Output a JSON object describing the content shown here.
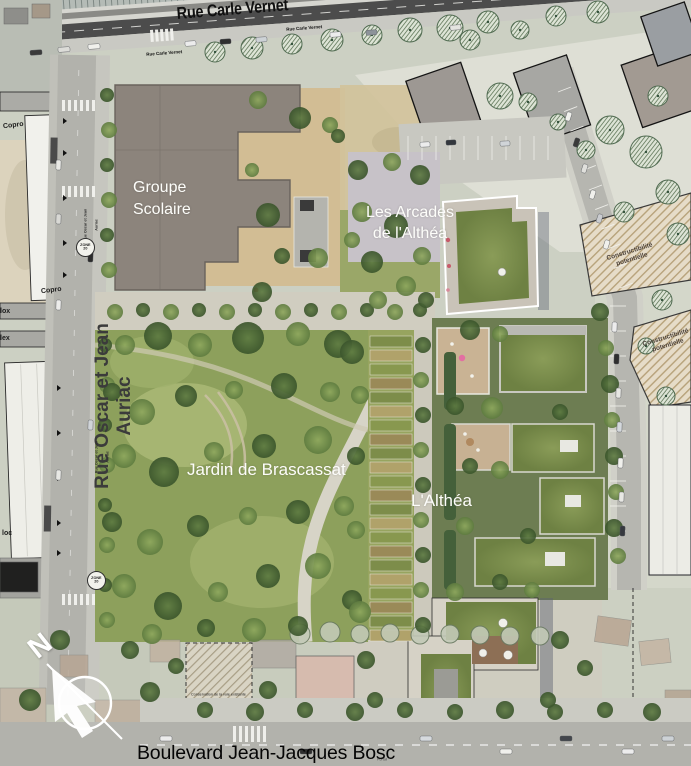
{
  "streets": {
    "carle_vernet": "Rue Carle Vernet",
    "oscar_jean_auriac": "Rue Oscar et Jean Auriac",
    "bosc": "Boulevard Jean-Jacques Bosc"
  },
  "places": {
    "groupe_scolaire": "Groupe\nScolaire",
    "les_arcades": "Les Arcades\nde l'Althéa",
    "jardin": "Jardin de Brascassat",
    "althea": "L'Althéa"
  },
  "labels": {
    "copro": "Copro",
    "frag1": "lox",
    "frag2": "lex",
    "frag3": "loc",
    "constructibilite": "Constructibilité\npotentielle",
    "conservation": "Conservation de la voie existante",
    "portail": "Portail",
    "zone20": "ZONE\n20",
    "north": "N"
  },
  "palette": {
    "asphalt_dark": "#4c4c4c",
    "road_light": "#b2b2ac",
    "park_green": "#8da05c",
    "tree_dark": "#3f5c30",
    "roof_green": "#7b8e4d",
    "school_roof": "#8c847c",
    "sand": "#d2bd94",
    "hatch_fill": "#e6dcc8",
    "label_white": "#fdfdfa",
    "label_dark": "#1c1c1c"
  }
}
